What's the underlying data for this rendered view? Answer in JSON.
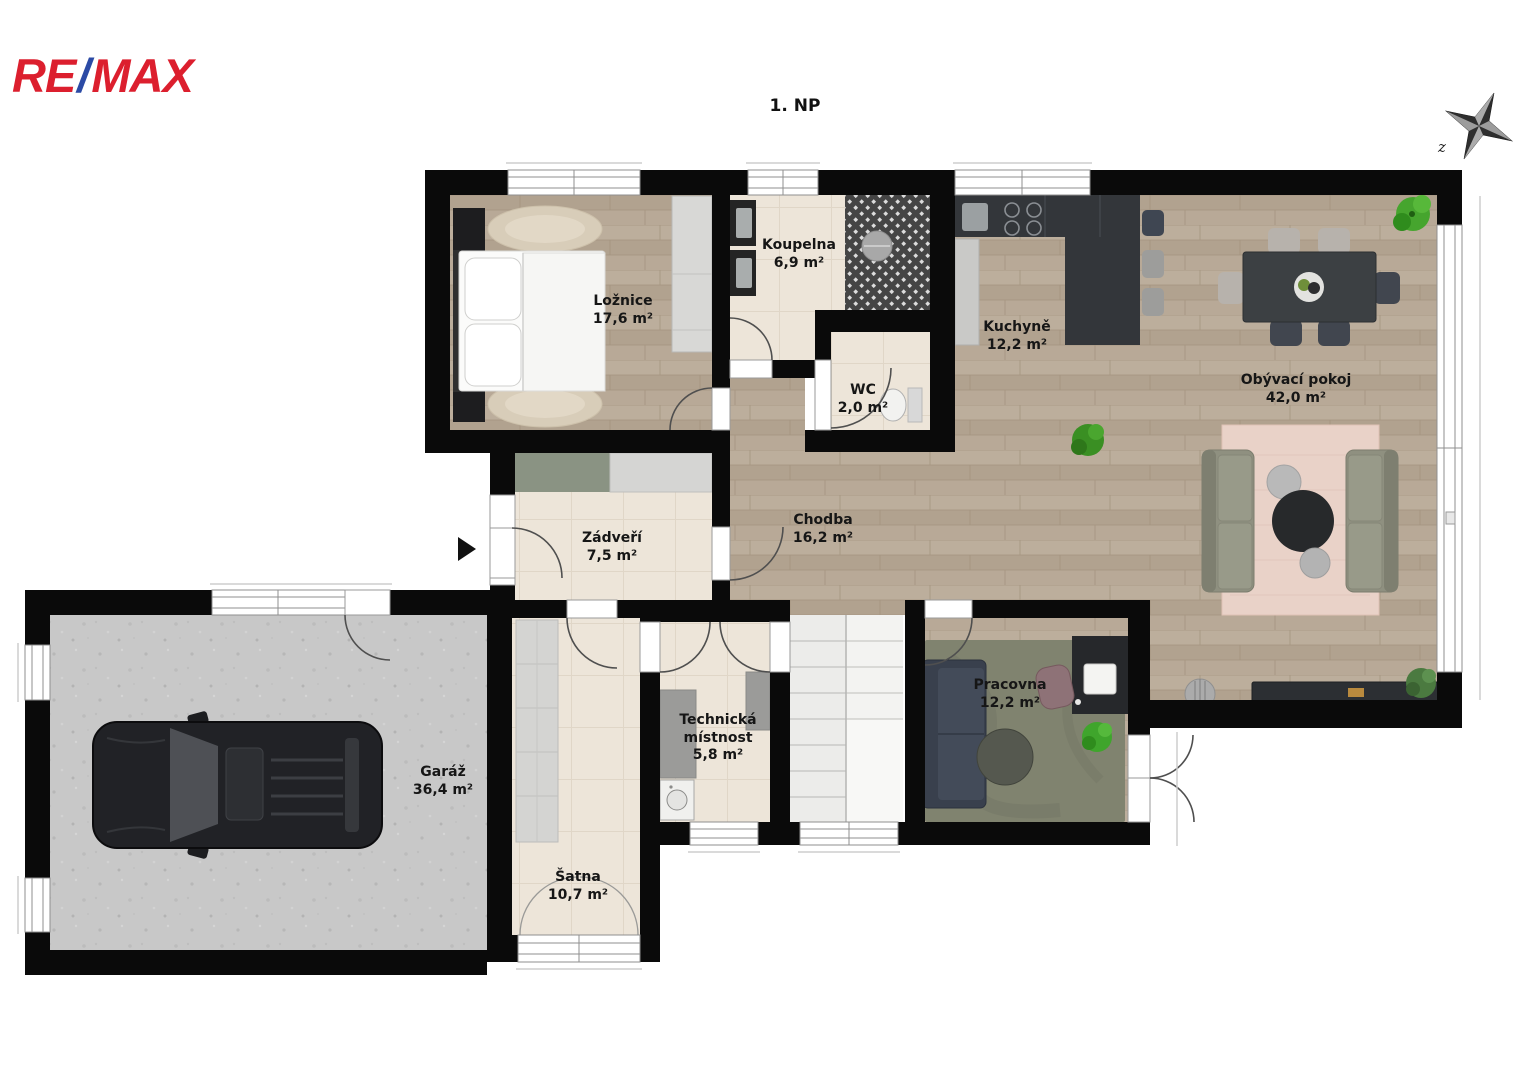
{
  "logo": {
    "re": "RE",
    "slash": "/",
    "max": "MAX",
    "red": "#dc1f2e",
    "blue": "#2b4aa5"
  },
  "title": "1. NP",
  "compass": {
    "label": "z"
  },
  "icons": {
    "entrance-marker": "right-triangle",
    "compass-rose": "four-point-star"
  },
  "rooms": [
    {
      "id": "loznice",
      "name": "Ložnice",
      "area": "17,6 m²"
    },
    {
      "id": "koupelna",
      "name": "Koupelna",
      "area": "6,9 m²"
    },
    {
      "id": "wc",
      "name": "WC",
      "area": "2,0 m²"
    },
    {
      "id": "kuchyne",
      "name": "Kuchyně",
      "area": "12,2 m²"
    },
    {
      "id": "obyvaci",
      "name": "Obývací pokoj",
      "area": "42,0 m²"
    },
    {
      "id": "zadveri",
      "name": "Zádveří",
      "area": "7,5 m²"
    },
    {
      "id": "chodba",
      "name": "Chodba",
      "area": "16,2 m²"
    },
    {
      "id": "garaz",
      "name": "Garáž",
      "area": "36,4 m²"
    },
    {
      "id": "satna",
      "name": "Šatna",
      "area": "10,7 m²"
    },
    {
      "id": "technicka",
      "name": "Technická místnost",
      "area": "5,8 m²"
    },
    {
      "id": "pracovna",
      "name": "Pracovna",
      "area": "12,2 m²"
    }
  ]
}
